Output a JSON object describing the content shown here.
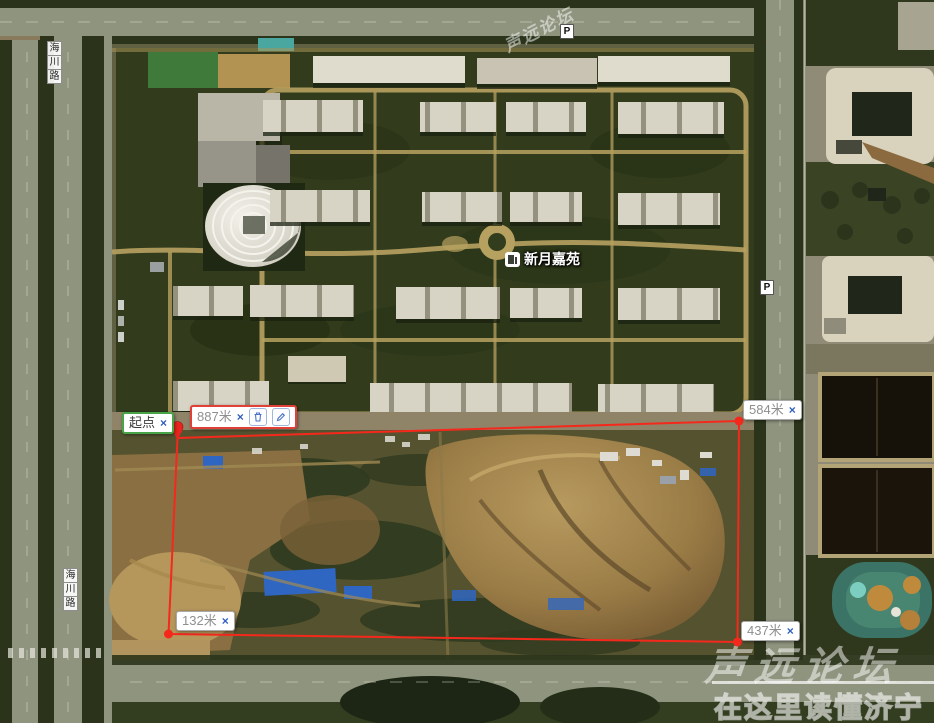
{
  "map": {
    "poi_label": "新月嘉苑",
    "parking_label": "P",
    "road_chars": [
      "海",
      "川",
      "路"
    ]
  },
  "measure_tool": {
    "start_label": "起点",
    "close_icon": "×",
    "distances": {
      "total": "887米",
      "right_top": "584米",
      "bottom_left": "132米",
      "bottom_right": "437米"
    },
    "colors": {
      "line_red": "#f5281c",
      "start_green": "#47a447",
      "total_border_red": "#e04038",
      "link_blue": "#2f5fc0"
    }
  },
  "watermark": {
    "diagonal": "声远论坛",
    "brand": "声远论坛",
    "tagline": "在这里读懂济宁"
  }
}
